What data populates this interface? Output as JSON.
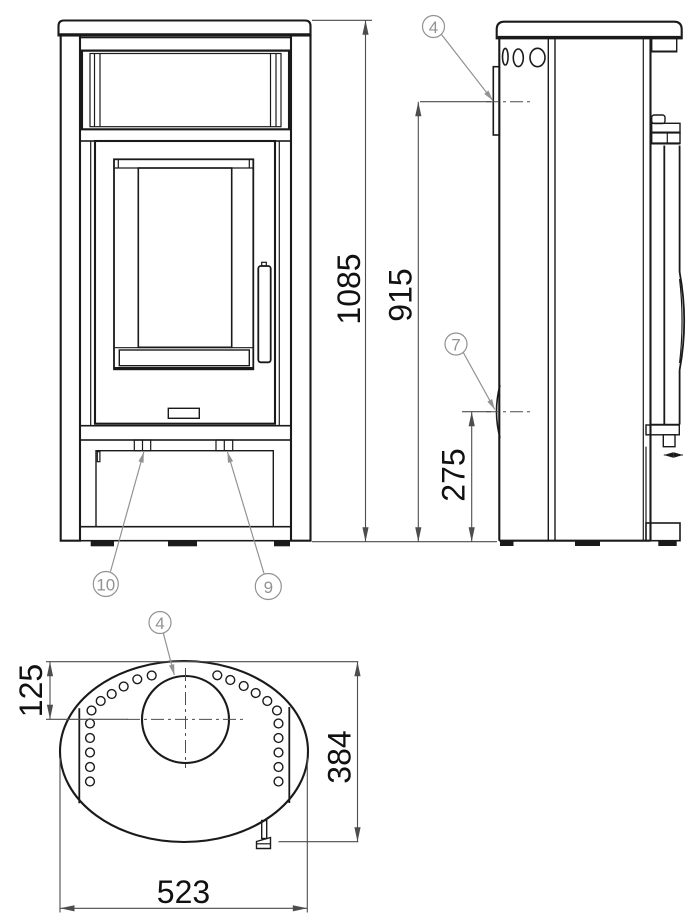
{
  "colors": {
    "background": "#ffffff",
    "line": "#1a1a1a",
    "dimension": "#4d4d4d",
    "callout": "#929292"
  },
  "dimensions": {
    "overall_height": "1085",
    "flue_height": "915",
    "rear_inlet_height": "275",
    "flue_center_offset": "125",
    "depth": "384",
    "width": "523"
  },
  "callouts": {
    "side_flue": "4",
    "rear_inlet": "7",
    "left_tab": "10",
    "right_tab": "9",
    "top_flue": "4"
  }
}
